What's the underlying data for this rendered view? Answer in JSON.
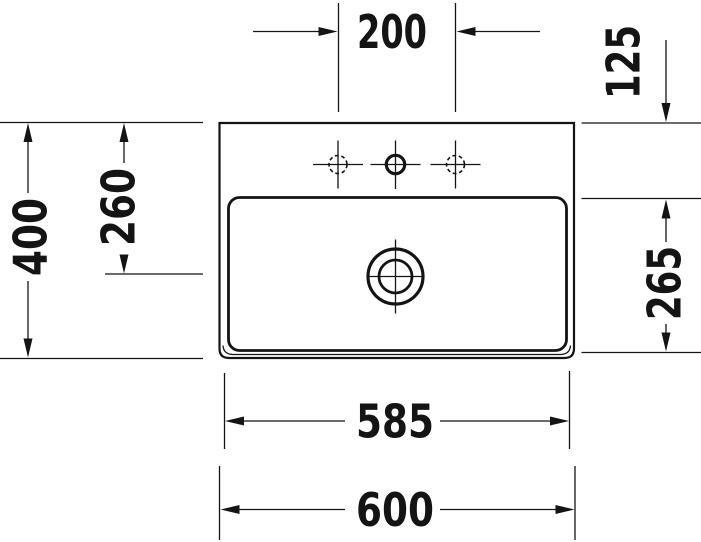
{
  "drawing": {
    "title": "Washbasin technical drawing, plan view",
    "labels": {
      "faucet_hole_spacing": "200",
      "back_rim_to_bowl": "125",
      "overall_depth": "400",
      "back_edge_to_drain": "260",
      "bowl_depth": "265",
      "bowl_width": "585",
      "overall_width": "600"
    },
    "symbols": {
      "drain": "drain-outlet-symbol",
      "center_faucet_hole": "faucet-hole-solid",
      "side_faucet_holes": "faucet-hole-dashed-optional"
    },
    "colors": {
      "line": "#141414",
      "background": "#ffffff"
    }
  }
}
